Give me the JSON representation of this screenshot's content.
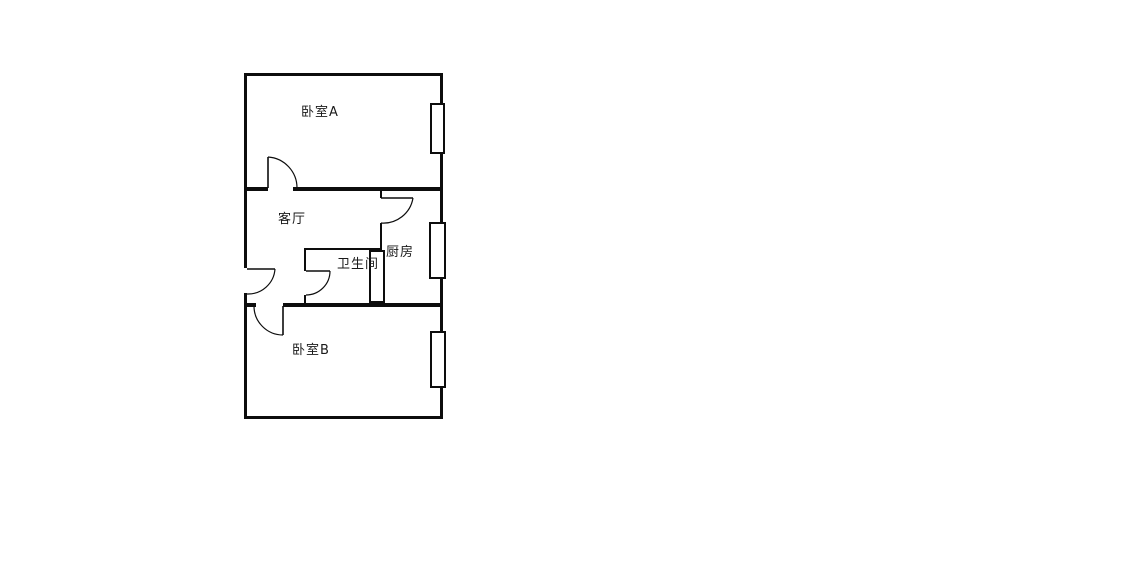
{
  "page": {
    "background": "#ffffff",
    "width": 1125,
    "height": 577
  },
  "floorplan": {
    "type": "floor-plan",
    "line_color": "#0d0d0d",
    "window_fill": "#ffffff",
    "label_color": "#1a1a1a",
    "rooms": [
      {
        "name": "bedroom-a",
        "label": "卧室A",
        "x": 301,
        "y": 106
      },
      {
        "name": "living-room",
        "label": "客厅",
        "x": 278,
        "y": 213
      },
      {
        "name": "kitchen",
        "label": "厨房",
        "x": 386,
        "y": 246
      },
      {
        "name": "bathroom",
        "label": "卫生间",
        "x": 337,
        "y": 258
      },
      {
        "name": "bedroom-b",
        "label": "卧室B",
        "x": 292,
        "y": 344
      }
    ],
    "walls": [
      {
        "name": "outer-wall-top",
        "x": 244,
        "y": 73,
        "w": 199,
        "h": 3
      },
      {
        "name": "outer-wall-left-upper",
        "x": 244,
        "y": 73,
        "w": 3,
        "h": 195
      },
      {
        "name": "outer-wall-left-lower",
        "x": 244,
        "y": 293,
        "w": 3,
        "h": 126
      },
      {
        "name": "outer-wall-right",
        "x": 440,
        "y": 73,
        "w": 3,
        "h": 346
      },
      {
        "name": "outer-wall-bottom",
        "x": 244,
        "y": 416,
        "w": 199,
        "h": 3
      },
      {
        "name": "wall-bedroomA-left-of-door",
        "x": 246,
        "y": 187,
        "w": 22,
        "h": 4
      },
      {
        "name": "wall-bedroomA-right-of-door",
        "x": 293,
        "y": 187,
        "w": 148,
        "h": 4
      },
      {
        "name": "wall-middle-left-of-door",
        "x": 246,
        "y": 303,
        "w": 10,
        "h": 4
      },
      {
        "name": "wall-middle-right-of-door",
        "x": 283,
        "y": 303,
        "w": 158,
        "h": 4
      },
      {
        "name": "kitchen-divider-upper-stub",
        "x": 380,
        "y": 191,
        "w": 2,
        "h": 7
      },
      {
        "name": "kitchen-divider-lower",
        "x": 380,
        "y": 223,
        "w": 2,
        "h": 27
      },
      {
        "name": "bathroom-wall-top",
        "x": 304,
        "y": 248,
        "w": 77,
        "h": 2
      },
      {
        "name": "bathroom-wall-left-upper",
        "x": 304,
        "y": 250,
        "w": 2,
        "h": 21
      },
      {
        "name": "bathroom-wall-left-stub",
        "x": 304,
        "y": 295,
        "w": 2,
        "h": 8
      }
    ],
    "windows": [
      {
        "name": "bedroom-a-window",
        "x": 431,
        "y": 104,
        "w": 13,
        "h": 49
      },
      {
        "name": "kitchen-window",
        "x": 430,
        "y": 223,
        "w": 15,
        "h": 55
      },
      {
        "name": "bathroom-window",
        "x": 370,
        "y": 251,
        "w": 14,
        "h": 51
      },
      {
        "name": "bedroom-b-window",
        "x": 431,
        "y": 332,
        "w": 14,
        "h": 55
      }
    ],
    "doors": [
      {
        "name": "bedroom-a-door",
        "leaf": [
          268,
          188,
          268,
          157
        ],
        "arc": "M 268,157 A 31,31 0 0 1 297,188"
      },
      {
        "name": "entry-door",
        "leaf": [
          247,
          269,
          275,
          269
        ],
        "arc": "M 275,269 A 27,27 0 0 1 247,294"
      },
      {
        "name": "kitchen-door",
        "leaf": [
          381,
          198,
          413,
          198
        ],
        "arc": "M 413,198 A 30,30 0 0 1 381,223"
      },
      {
        "name": "bathroom-door",
        "leaf": [
          306,
          271,
          330,
          271
        ],
        "arc": "M 330,271 A 24,24 0 0 1 306,295"
      },
      {
        "name": "bedroom-b-door",
        "leaf": [
          283,
          306,
          283,
          335
        ],
        "arc": "M 283,335 A 29,29 0 0 1 254,306"
      }
    ]
  }
}
